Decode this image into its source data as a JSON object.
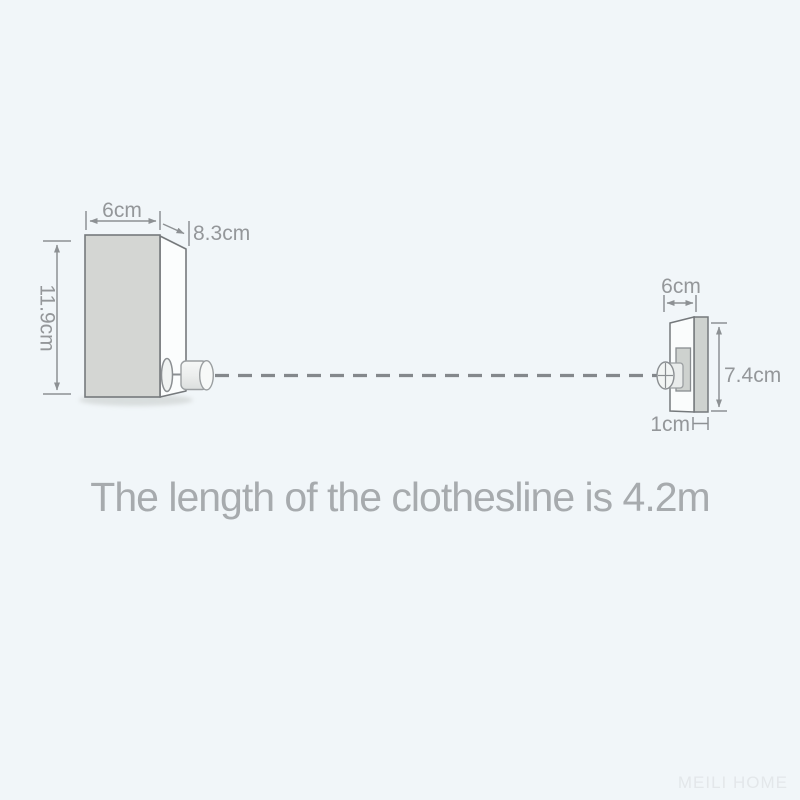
{
  "title": {
    "text": "The length of the clothesline is 4.2m"
  },
  "watermark": {
    "text": "MEILI HOME"
  },
  "diagram": {
    "left_unit": {
      "name": "retractable clothesline main unit",
      "width_label": "6cm",
      "depth_label": "8.3cm",
      "height_label": "11.9cm"
    },
    "right_unit": {
      "name": "wall hook bracket",
      "width_label": "6cm",
      "height_label": "7.4cm",
      "depth_label": "1cm"
    },
    "clothesline_length": "4.2m",
    "colors": {
      "background": "#f1f6f9",
      "box_front_fill": "#d4d6d3",
      "box_side_fill": "#fbfdfd",
      "bracket_front_fill": "#fafcfc",
      "bracket_strip_fill": "#ced2cf",
      "outline_gray": "#75797c",
      "dimension_line_gray": "#8d9194",
      "dash_line_gray": "#84888c",
      "label_text_gray": "#94979a",
      "title_text_gray": "#a7abae",
      "watermark_gray": "#e3e7ea"
    }
  }
}
